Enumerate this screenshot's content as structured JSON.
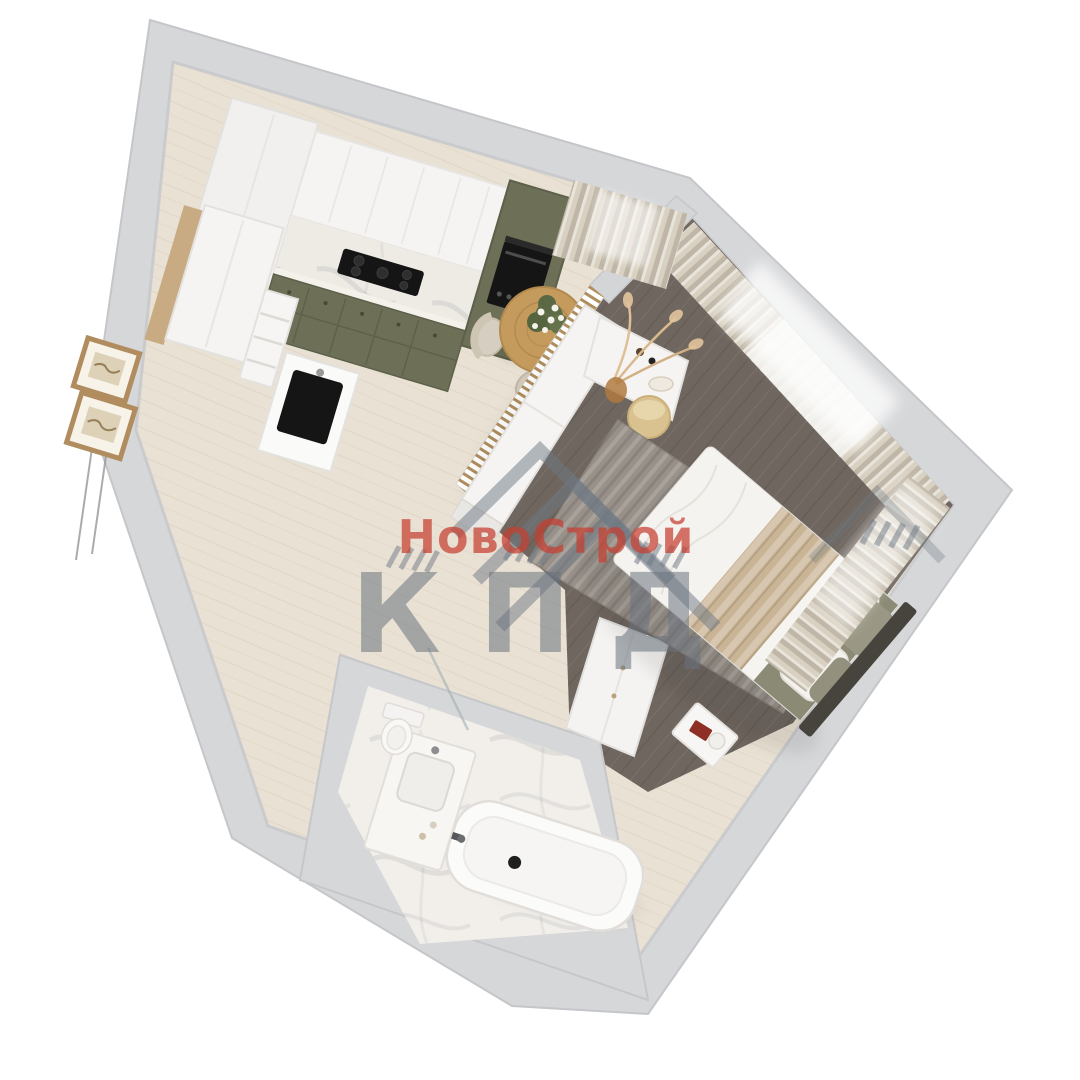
{
  "watermark": {
    "brand_line": "НовоСтрой",
    "brand_line2": "КПД",
    "red": "rgba(198,62,48,0.72)",
    "gray": "rgba(105,115,126,0.55)",
    "chevron_color": "rgba(110,120,132,0.50)"
  },
  "palette": {
    "background": "#ffffff",
    "wall": "#d6d7d9",
    "floor_light": "#e9e1d3",
    "floor_dark": "#6f665f",
    "marble": "#f2efeb",
    "cabinet_olive": "#6d7057",
    "furniture_white": "#f5f4f2",
    "wood": "#c49a5d",
    "curtain_beige": "#d8d0c0",
    "sheer_white": "#f5f5f3",
    "rug_gray": "#98918a",
    "bed_olive": "#8b8a75",
    "bedding_knit": "#c9b495",
    "headboard": "#47443d",
    "appliance_black": "#151515"
  }
}
